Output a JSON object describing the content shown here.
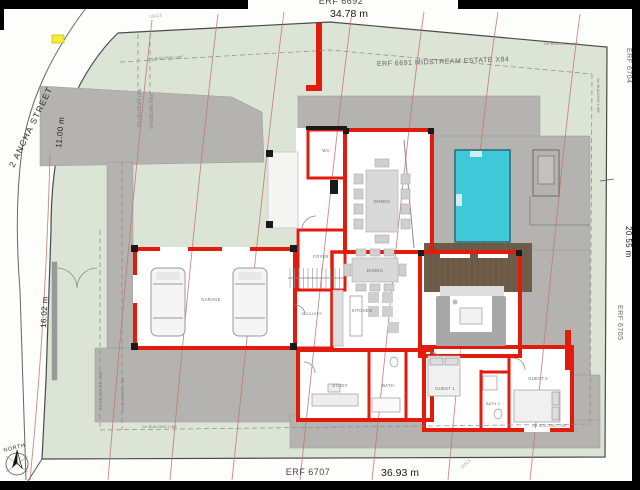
{
  "plan": {
    "erf_top": "ERF 6692",
    "dim_top": "34.78 m",
    "neighbor_top": "ERF 6691 MIDSTREAM ESTATE X84",
    "erf_right_top": "ERF 6704",
    "dim_right": "20.55 m",
    "erf_right_bottom": "ERF 6705",
    "erf_bottom": "ERF 6707",
    "dim_bottom": "36.93 m",
    "street": "2 ANCHA STREET",
    "dim_street": "11.00 m",
    "dim_left": "16.02 m",
    "north": "NORTH",
    "contour_label": "1522.5"
  },
  "building_lines": {
    "two_m": "2m BUILDING LINE",
    "three_five_m": "3.5m BUILDING LINE",
    "five_m": "5m BUILDING LINE"
  },
  "rooms": {
    "garage": "GARAGE",
    "scullery": "SCULLERY",
    "foyer": "FOYER",
    "wc": "WC",
    "dining_upper": "DINING",
    "dining": "DINING",
    "kitchen": "KITCHEN",
    "study": "STUDY",
    "bath": "BATH",
    "guest1": "GUEST 1",
    "bath2": "BATH 2",
    "guest2": "GUEST 2"
  },
  "colors": {
    "wall_red": "#e31b0c",
    "pool_blue": "#3fc8d8",
    "deck_brown": "#6f5c49",
    "paving_gray": "#b5b3b0",
    "site_green": "#dbe4d5",
    "contour_red": "#c4766e",
    "highlight_yellow": "#f5ee30"
  }
}
